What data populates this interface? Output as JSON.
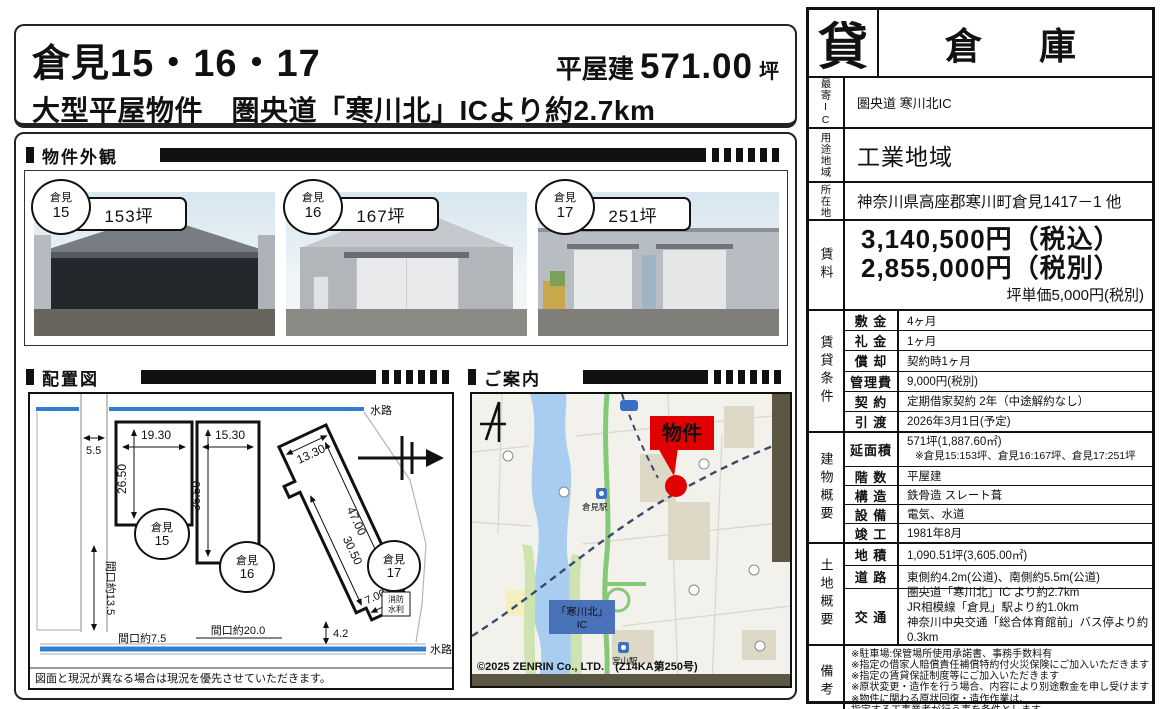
{
  "header": {
    "title": "倉見15・16・17",
    "size_prefix": "平屋建",
    "size_value": "571.00",
    "size_unit": "坪",
    "subtitle": "大型平屋物件　圏央道「寒川北」ICより約2.7km"
  },
  "sections": {
    "photos": "物件外観",
    "plan": "配置図",
    "map": "ご案内"
  },
  "photos": [
    {
      "badge_name": "倉見",
      "badge_no": "15",
      "area": "153坪"
    },
    {
      "badge_name": "倉見",
      "badge_no": "16",
      "area": "167坪"
    },
    {
      "badge_name": "倉見",
      "badge_no": "17",
      "area": "251坪"
    }
  ],
  "plan": {
    "waterway_top": "水路",
    "waterway_bottom": "水路",
    "road_width": "5.5",
    "b15_width": "19.30",
    "b15_depth": "26.50",
    "b16_width": "15.30",
    "b16_depth": "36.50",
    "b17_edge_top": "13.30",
    "b17_edge_long": "47.00",
    "b17_edge_inner": "30.50",
    "b17_edge_foot": "7.00",
    "frontage_left": "間口約13.5",
    "frontage_bottom_left": "間口約7.5",
    "frontage_bottom_mid": "間口約20.0",
    "gap_right": "4.2",
    "fire_line1": "消防",
    "fire_line2": "水利",
    "c15_top": "倉見",
    "c15_no": "15",
    "c16_top": "倉見",
    "c16_no": "16",
    "c17_top": "倉見",
    "c17_no": "17",
    "note": "図面と現況が異なる場合は現況を優先させていただきます。"
  },
  "map": {
    "marker": "物件",
    "ic_line1": "「寒川北」",
    "ic_line2": "IC",
    "station1": "倉見駅",
    "station2": "宮山駅",
    "copyright": "©2025 ZENRIN Co., LTD.　(Z14KA第250号)"
  },
  "spec": {
    "tag": "貸",
    "category": "倉　庫",
    "nearest_ic_label": "最寄IC",
    "nearest_ic": "圏央道 寒川北IC",
    "zoning_label": "用途地域",
    "zoning": "工業地域",
    "address_label": "所在地",
    "address": "神奈川県高座郡寒川町倉見1417－1 他",
    "rent_label": "賃料",
    "rent_incl_tax": "3,140,500円（税込）",
    "rent_excl_tax": "2,855,000円（税別）",
    "rent_unit": "坪単価5,000円(税別)",
    "lease_label": "賃貸条件",
    "lease": [
      {
        "k": "敷 金",
        "v": "4ヶ月"
      },
      {
        "k": "礼 金",
        "v": "1ヶ月"
      },
      {
        "k": "償 却",
        "v": "契約時1ヶ月"
      },
      {
        "k": "管理費",
        "v": "9,000円(税別)"
      },
      {
        "k": "契 約",
        "v": "定期借家契約 2年（中途解約なし）"
      },
      {
        "k": "引 渡",
        "v": "2026年3月1日(予定)"
      }
    ],
    "building_label": "建物概要",
    "building": [
      {
        "k": "延面積",
        "v": "571坪(1,887.60㎡)",
        "v2": "※倉見15:153坪、倉見16:167坪、倉見17:251坪"
      },
      {
        "k": "階 数",
        "v": "平屋建"
      },
      {
        "k": "構 造",
        "v": "鉄骨造 スレート葺"
      },
      {
        "k": "設 備",
        "v": "電気、水道"
      },
      {
        "k": "竣 工",
        "v": "1981年8月"
      }
    ],
    "land_label": "土地概要",
    "land": [
      {
        "k": "地 積",
        "v": "1,090.51坪(3,605.00㎡)"
      },
      {
        "k": "道 路",
        "v": "東側約4.2m(公道)、南側約5.5m(公道)"
      },
      {
        "k": "交 通",
        "v": "圏央道「寒川北」IC より約2.7km",
        "v2": "JR相模線「倉見」駅より約1.0km",
        "v3": "神奈川中央交通「総合体育館前」バス停より約0.3km"
      }
    ],
    "notes_label": "備考",
    "notes": [
      "※駐車場:保管場所使用承諾書、事務手数料有",
      "※指定の借家人賠償責任補償特約付火災保険にご加入いただきます",
      "※指定の賃貸保証制度等にご加入いただきます",
      "※原状変更・造作を行う場合、内容により別途敷金を申し受けます",
      "※物件に関わる原状回復・造作作業は、",
      "指定する工事業者が行う事を条件とします"
    ]
  }
}
